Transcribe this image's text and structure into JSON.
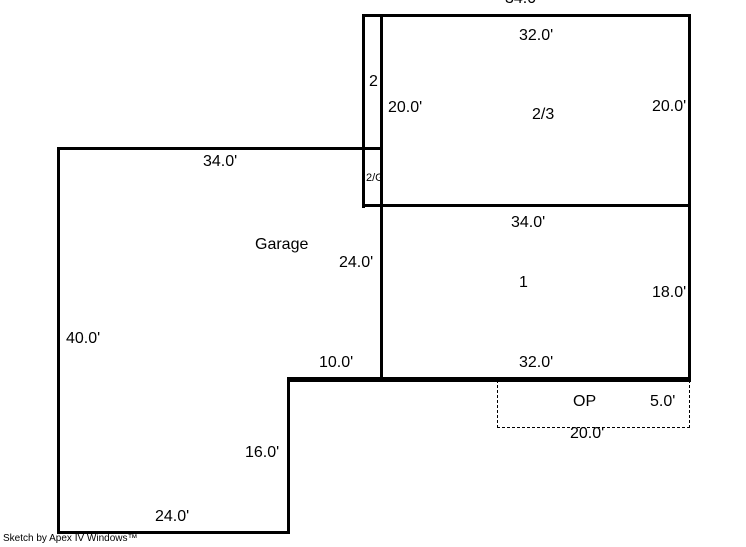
{
  "title": "Floor plan sketch",
  "credit": "Sketch by Apex IV Windows™",
  "colors": {
    "wall": "#000000",
    "background": "#ffffff",
    "text": "#000000"
  },
  "areas": {
    "garage": "Garage",
    "first_floor": "1",
    "second_floor": "2",
    "second_third_floor": "2/3",
    "second_over_garage": "2/G",
    "open_porch": "OP"
  },
  "dimensions": {
    "upper_top_outer": "34.0'",
    "upper_top_inner": "32.0'",
    "upper_left_height": "20.0'",
    "upper_right_height": "20.0'",
    "first_top_width": "34.0'",
    "first_right_height": "18.0'",
    "first_bottom_width": "32.0'",
    "garage_top_width": "34.0'",
    "garage_right_height": "24.0'",
    "garage_left_height": "40.0'",
    "garage_step_width": "10.0'",
    "garage_lower_right_height": "16.0'",
    "garage_bottom_width": "24.0'",
    "porch_right_height": "5.0'",
    "porch_bottom_width": "20.0'"
  }
}
